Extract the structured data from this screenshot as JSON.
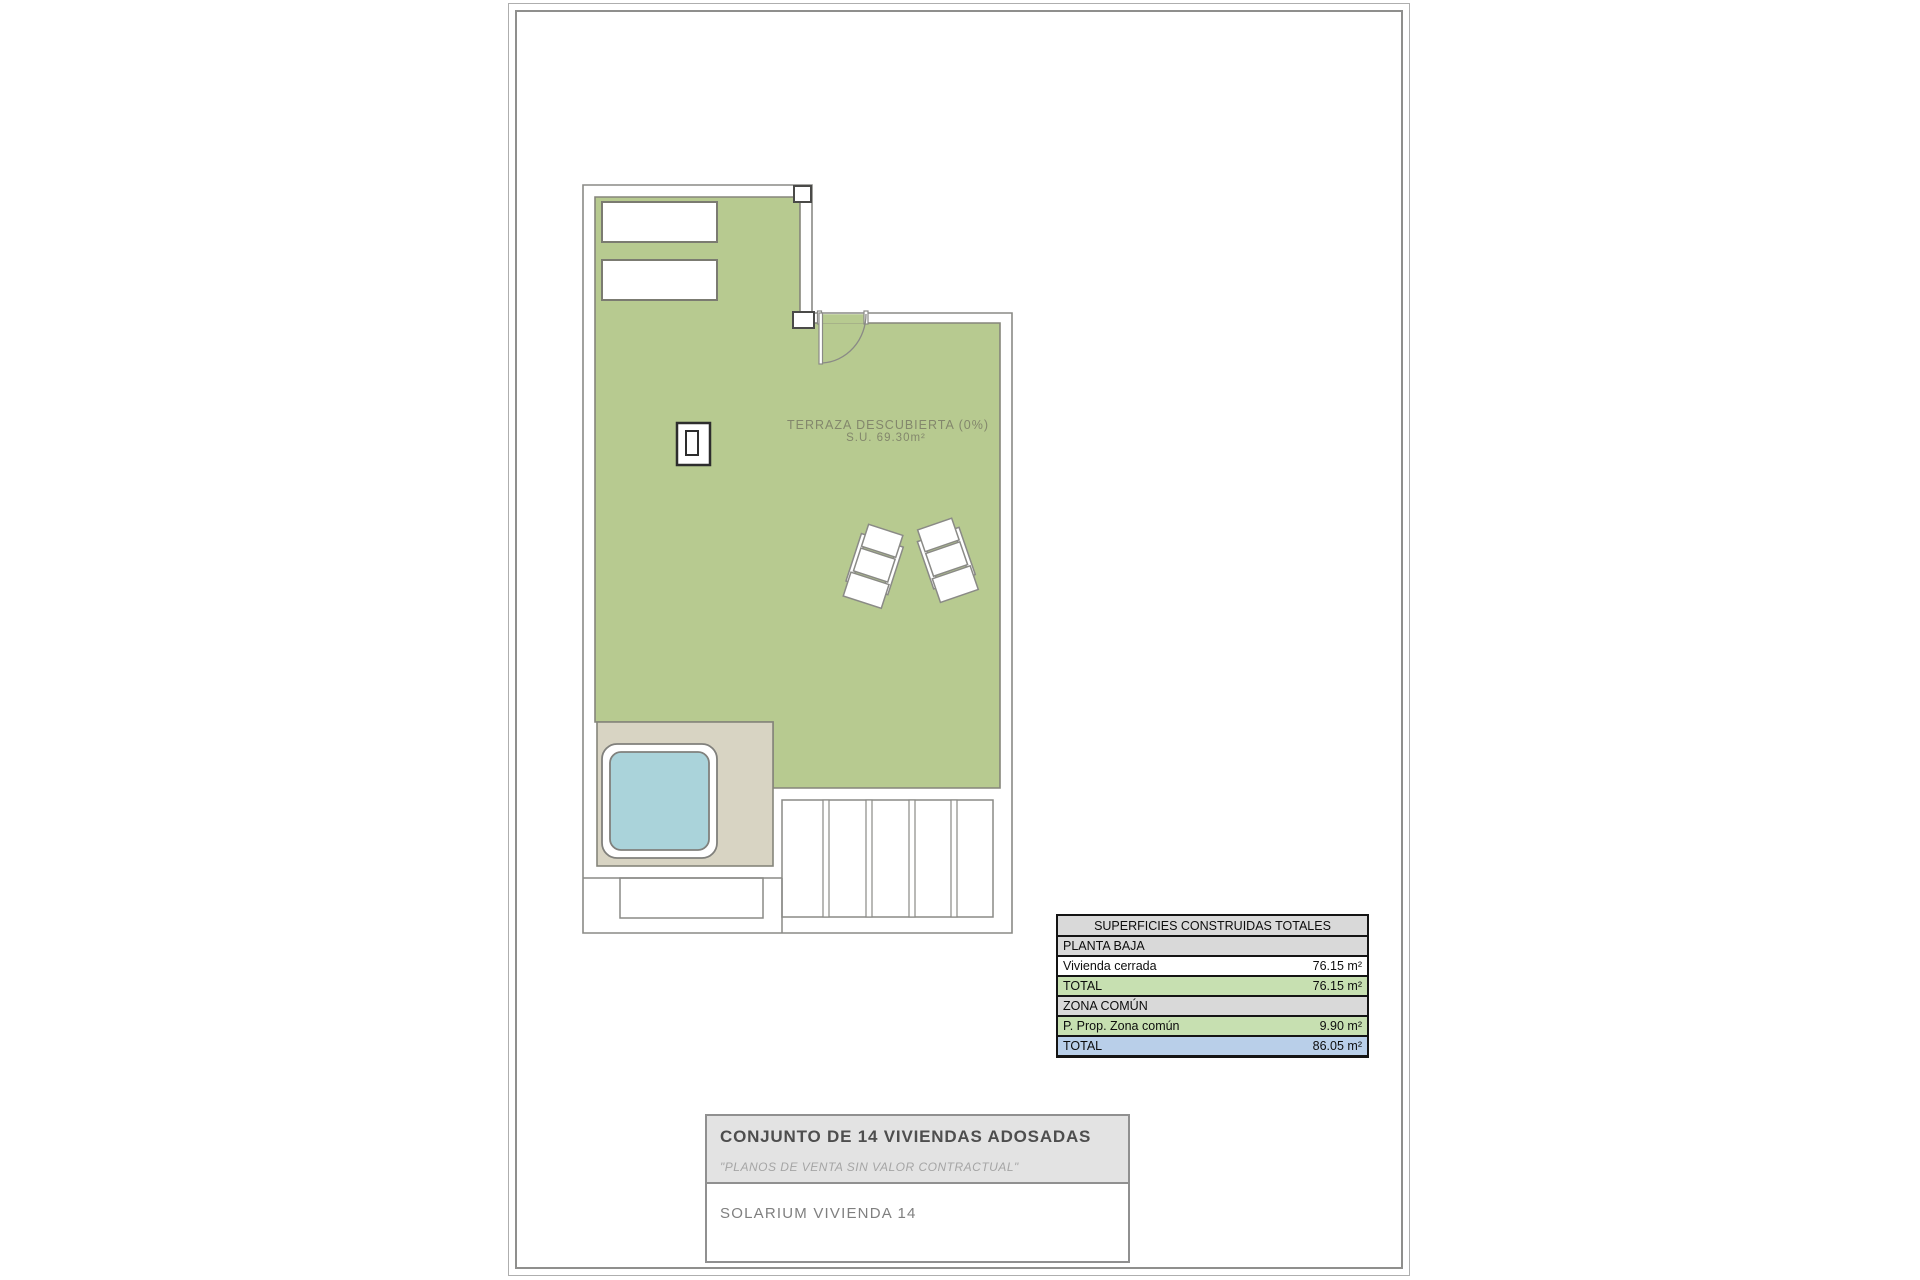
{
  "plan": {
    "terrace_label": "TERRAZA DESCUBIERTA (0%)",
    "terrace_area": "S.U. 69.30m²"
  },
  "areas_table": {
    "title": "SUPERFICIES CONSTRUIDAS TOTALES",
    "rows": [
      {
        "label": "PLANTA BAJA",
        "value": ""
      },
      {
        "label": "Vivienda cerrada",
        "value": "76.15 m²"
      },
      {
        "label": "TOTAL",
        "value": "76.15 m²"
      },
      {
        "label": "ZONA COMÚN",
        "value": ""
      },
      {
        "label": "P. Prop. Zona común",
        "value": "9.90 m²"
      },
      {
        "label": "TOTAL",
        "value": "86.05 m²"
      }
    ]
  },
  "title_block": {
    "project": "CONJUNTO DE 14 VIVIENDAS ADOSADAS",
    "disclaimer": "\"PLANOS DE VENTA SIN VALOR CONTRACTUAL\"",
    "sheet": "SOLARIUM VIVIENDA 14"
  },
  "colors": {
    "terrace_green": "#b7ca90",
    "deck_tan": "#d8d4c3",
    "pool_blue": "#aad3da",
    "table_row_green": "#c7e0b1",
    "table_row_blue": "#b9cfe9",
    "table_row_gray": "#d9d9d9",
    "drawing_line_gray": "#8a8a86"
  }
}
